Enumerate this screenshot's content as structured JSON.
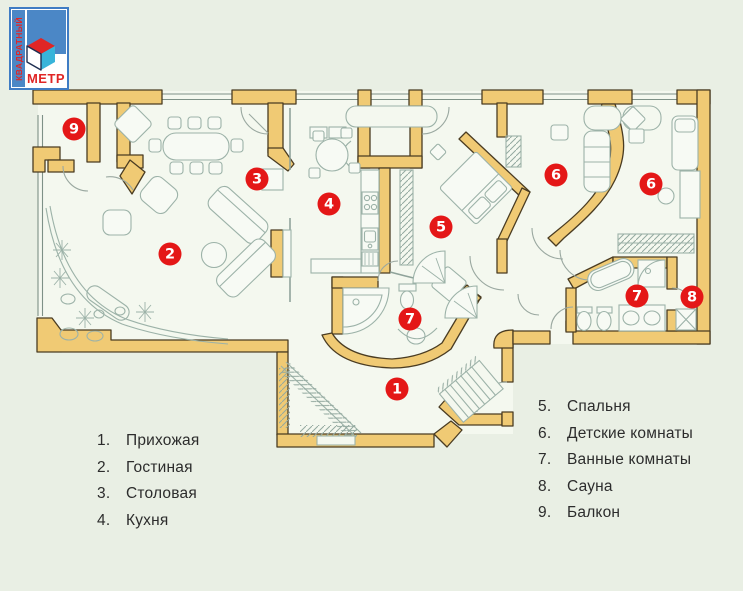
{
  "logo": {
    "vertical_text": "КВАДРАТНЫЙ",
    "bottom_text": "МЕТР"
  },
  "legend_left": [
    {
      "number": "1.",
      "label": "Прихожая"
    },
    {
      "number": "2.",
      "label": "Гостиная"
    },
    {
      "number": "3.",
      "label": "Столовая"
    },
    {
      "number": "4.",
      "label": "Кухня"
    }
  ],
  "legend_right": [
    {
      "number": "5.",
      "label": "Спальня"
    },
    {
      "number": "6.",
      "label": "Детские комнаты"
    },
    {
      "number": "7.",
      "label": "Ванные комнаты"
    },
    {
      "number": "8.",
      "label": "Сауна"
    },
    {
      "number": "9.",
      "label": "Балкон"
    }
  ],
  "markers": [
    {
      "label": "1",
      "x": 397,
      "y": 389
    },
    {
      "label": "2",
      "x": 170,
      "y": 254
    },
    {
      "label": "3",
      "x": 257,
      "y": 179
    },
    {
      "label": "4",
      "x": 329,
      "y": 204
    },
    {
      "label": "5",
      "x": 441,
      "y": 227
    },
    {
      "label": "6",
      "x": 556,
      "y": 175
    },
    {
      "label": "6",
      "x": 651,
      "y": 184
    },
    {
      "label": "7",
      "x": 410,
      "y": 319
    },
    {
      "label": "7",
      "x": 637,
      "y": 296
    },
    {
      "label": "8",
      "x": 692,
      "y": 297
    },
    {
      "label": "9",
      "x": 74,
      "y": 129
    }
  ],
  "colors": {
    "background": "#e9efe4",
    "room_fill": "#f4f8ef",
    "wall_fill": "#f0ca74",
    "wall_stroke": "#4a3c22",
    "furniture_stroke": "#9cb2a8",
    "marker_red": "#e41717",
    "logo_blue": "#4b87c6",
    "logo_red": "#e02525",
    "cube_cyan": "#38b4da"
  }
}
